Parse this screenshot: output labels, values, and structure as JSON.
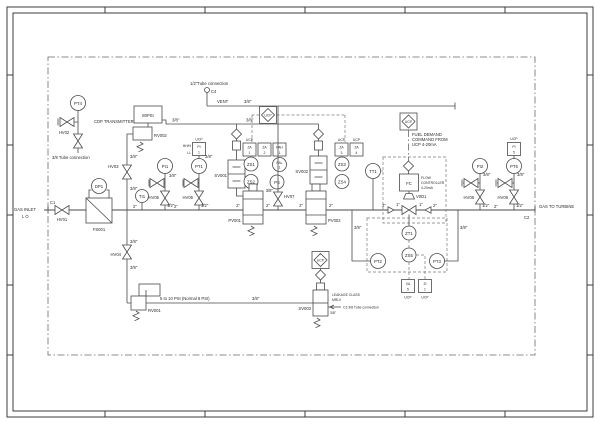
{
  "colors": {
    "line": "#4a4a4a",
    "text": "#2b2b2b",
    "background": "#ffffff"
  },
  "sizes": {
    "s38": "3/8\"",
    "s2": "2\"",
    "s12": "1/2\"",
    "s1": "1\""
  },
  "labels": {
    "gas_inlet_1": "GAS INLET",
    "gas_inlet_2": "L O",
    "gas_outlet": "GAS TO TURBINE",
    "c1": "C1",
    "c2": "C2",
    "c4": "C4",
    "hv01": "HV01",
    "hv02": "HV02",
    "hv03": "HV03",
    "hv04": "HV04",
    "hv05": "HV05",
    "hv06": "HV06",
    "hv07": "HV07",
    "hv08": "HV08",
    "hv09": "HV09",
    "fs001": "FS001",
    "dp1": "DP1",
    "ti1": "TI1",
    "pi1": "PI1",
    "pi2": "PI2",
    "pt1": "PT1",
    "pt2": "PT2",
    "pt3": "PT3",
    "pt4": "PT4",
    "pt5": "PT5",
    "tt1": "TT1",
    "zt1": "ZT1",
    "zs1": "ZS1",
    "zs2": "ZS2",
    "zs3": "ZS3",
    "zs4": "ZS4",
    "zs5": "ZS5",
    "ps": "PS",
    "pal_1": "PAL",
    "pal_2": "1",
    "sv001": "SV001",
    "sv002": "SV002",
    "sv003": "SV003",
    "pv001": "PV001",
    "pv002": "PV002",
    "rv001": "RV001",
    "rv002": "RV002",
    "v0d1": "V0D1",
    "fc": "FC",
    "cdp_transmitter": "CDP TRANSMITTER",
    "tube_conn_38": "3/8 Tube connection",
    "tube_conn_12": "1/2\"Tube connection",
    "vent": "VENT",
    "set_80psi": "80PSI",
    "rv001_note": "5 to 10 PSI (Normal 8 PSI)",
    "fuel_demand_1": "FUEL DEMAND",
    "fuel_demand_2": "COMMAND FROM",
    "fuel_demand_3": "UCP 4-20mA",
    "fc_note_1": "FLOW",
    "fc_note_2": "CONTROLLER",
    "fc_note_3": "4-20mA",
    "leakage_1": "LEAKAGE CLASS",
    "leakage_2": "MRLV",
    "c3_note": "C3 3/8 Tube connection",
    "ucp": "UCP",
    "hh": "HH/H",
    "ll": "LL"
  },
  "ucp_boxes": {
    "pt1": [
      "PI",
      "1"
    ],
    "za1": [
      "ZA",
      "1"
    ],
    "za2": [
      "ZA",
      "2"
    ],
    "pah": [
      "PAH",
      "1"
    ],
    "za3": [
      "ZA",
      "3"
    ],
    "za4": [
      "ZA",
      "4"
    ],
    "xa5": [
      "XA",
      "5"
    ],
    "zi1": [
      "ZI",
      "1"
    ],
    "pi5": [
      "PI",
      "5"
    ]
  }
}
